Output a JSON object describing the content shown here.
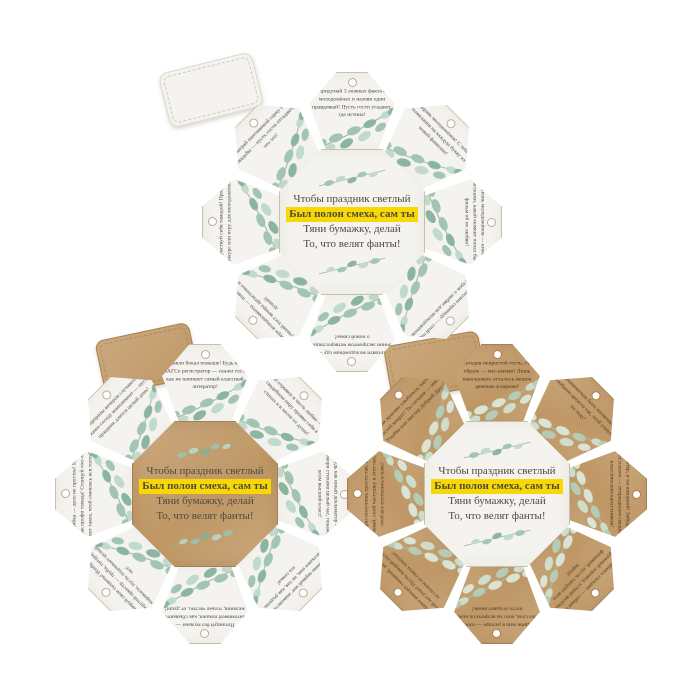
{
  "colors": {
    "background": "#ffffff",
    "paper": "#f4f3ef",
    "kraft": "#cba97e",
    "kraft2": "#bf9766",
    "highlight": "#f8d703",
    "ink": "#4c4b41",
    "inkKraft": "#4c3a22",
    "leaf1": "#9cc2ae",
    "leaf2": "#bcd8c8",
    "leaf3": "#82b09a",
    "stem": "#8fae98",
    "leafk1": "#dcebdf",
    "leafk2": "#cfe3d4",
    "leafk3": "#b3d0bd",
    "stemk": "#a7c2ad",
    "borderLight": "#cdbfa2",
    "borderKraft": "#a8804f",
    "holeRim": "#b9ab90"
  },
  "verse": {
    "line1": "Чтобы праздник светлый",
    "line2": "Был полон смеха, сам ты",
    "line3": "Тяни бумажку, делай",
    "line4": "То, что велят фанты!"
  },
  "wheels": [
    {
      "label": "white-tags-white-center",
      "petal_style": "paper",
      "center_style": "paper",
      "tasks": [
        "Придумай 3 ложных факта о молодожёнах и назови один правдивый! Пусть гости угадают, где истина!",
        "Поздравь молодожёнов! С тебя — пожелания на каждую букву их новой фамилии!",
        "Жизнь молодожёнов — кино! Расскажи, какой момент попал бы в фильм об их любви!",
        "Исполни серенаду — спой пару строк о любви для молодожёнов!",
        "Посвяти молодожёнам оду — сочини экспромтом четверостишие о новой семье!",
        "Собери аплодисменты — повтори лучший тост вечера артистично и с душой!",
        "Почувствуй себя тамадой! Проведи конкурс или игру для молодожёнов!",
        "Сыграй пантомимой сцену со свадьбы — пусть гости отгадают, что это!"
      ]
    },
    {
      "label": "white-tags-kraft-center",
      "petal_style": "paper",
      "center_style": "kraft",
      "tasks": [
        "Подняли бокал повыше! Будь как в ЗАГСе регистратор — скажи тост, как не напишет самый классный литератор!",
        "Спой отрывок в честь любви — на свадебном пиру прояви себя в стихах и в песне от души!",
        "Будь как юный декламатор — говори стихами целый час, покажи всем высший класс!",
        "Вспомни первый миг знакомства — расскажи нам, не тая, как родилась эта семья!",
        "Потанцуй без музыки — пантомимой покажи, как сбываются желания, только честно, от души!",
        "Тренируй свои таланты! Изобрази крутой оркестр — труба, гитара, маракасы, пусть подпевает целый зал!",
        "Ошибка — дело не простое! Будь как профи тамада! Станцуй что-то вот такое, чтоб смеялась вся толпа!",
        "Сюрпризы вечером случаются! Скажи соседу комплимент — пусть праздник длится целый день!"
      ]
    },
    {
      "label": "kraft-tags-white-center",
      "petal_style": "kraft",
      "center_style": "paper",
      "tasks": [
        "Ты сегодня непростой гость, стал в образе — маг-шаман! Лишь наколдовать осталось мешок денежек в карман!",
        "Знаменитым быть желаешь? Изобрази артиста так, чтоб узнали на ходу!",
        "Ты актёр, и ты юморной! Забудь про всё плохое — отпразднуем смешно классическим капустником!",
        "Улыбнись соседям — собери их в дружный хоровод, устрой весёлый флешмоб, пусть танцует весь народ!",
        "Праздник наш в разгаре — изобрази без слов, кого ты встретил в зале, пусть угадают вновь!",
        "Расскажи анекдот смешной, да так, чтоб зал упал! Пусть каждый гость за столом от смеха хохотал!",
        "Приз получишь просто так: не зевай, спой частушку в этот час, чтоб все пустились в пляс!",
        "Как красиво улыбаться, научи гостей вокруг! Ты сегодня — мисс Улыбка или мистер Добрый Друг!"
      ]
    }
  ]
}
